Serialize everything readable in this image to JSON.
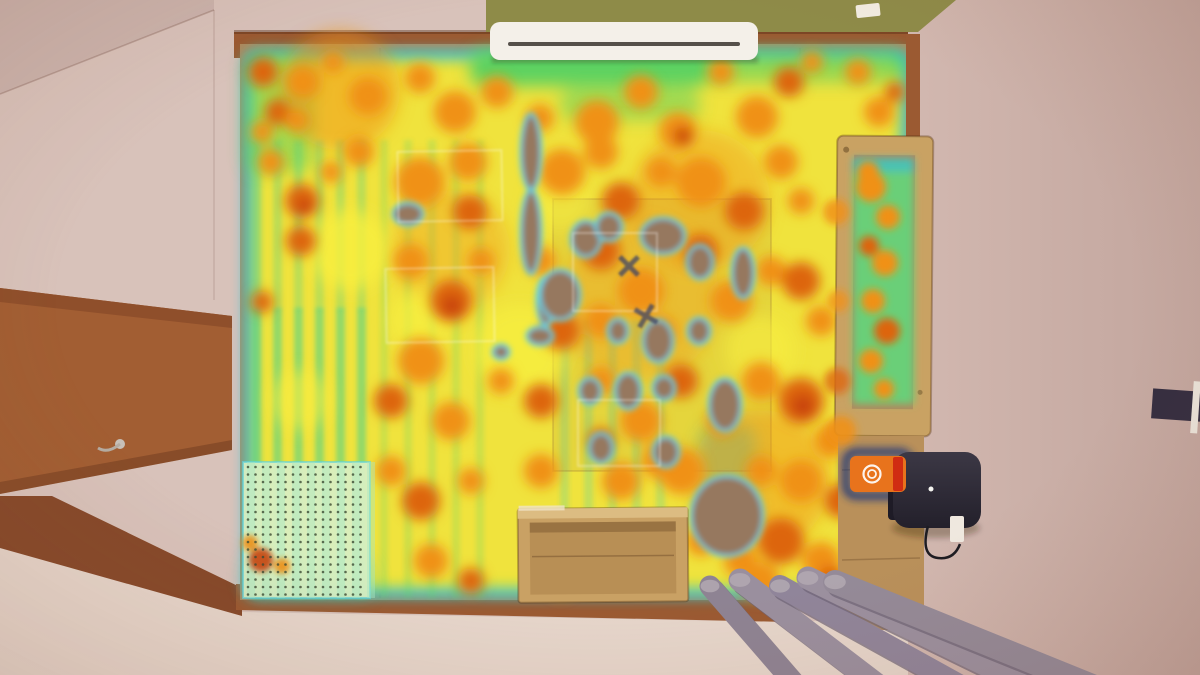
{
  "scene": {
    "description": "Top-down photo of a test room with a robot-vacuum coverage heatmap overlaid on the floor",
    "palette": {
      "wall": "#d8c2ba",
      "ceiling_shade": "#cbb3ac",
      "wall_right": "#d2b8b0",
      "wall_right_edge": "#c2a59d",
      "wall_bottom": "#e6d6cb",
      "green_wall": "#8e8b48",
      "trim": "#9b5a32",
      "trim_dark": "#86492a",
      "door": "#a25e33",
      "door_dark": "#8f4f2b",
      "floor": "#b2885d",
      "bed_wood": "#c9a263",
      "platform_wood": "#b9905a",
      "box_wood": "#c9a164",
      "box_rim": "#dcbc82",
      "box_inner": "#b88f55",
      "ac_body": "#f4f0e9",
      "ac_vent": "#55504a",
      "dock_top": "#3c3845",
      "dock_bottom": "#23202b",
      "dock_side": "#1e1b26",
      "dock_led": "#f5f5f0",
      "marker_orange": "#e8731c",
      "marker_red": "#d02c12",
      "marker_glow": "#16327c",
      "outlet": "#efe8df",
      "cable": "#1d1c22",
      "switch": "#f2ece2",
      "device": "#352e40",
      "device_clip": "#e9e2d8"
    },
    "heat": {
      "colors": {
        "y": "#f7ef3f",
        "c": "#f09119",
        "d": "#dd650e",
        "r": "#c8430d",
        "g": "#55d162",
        "t": "#3fd0b4",
        "b": "#35b9dc"
      },
      "edge": {
        "cyan": "#2fc4de",
        "green": "#52d44e",
        "yellow": "#f0e33c"
      },
      "hole_fill": "#96785f",
      "hole_rim": "#5bd0e8",
      "cold_rects": [
        [
          470,
          50,
          240,
          36,
          "g",
          0.95
        ],
        [
          700,
          50,
          206,
          32,
          "g",
          0.6
        ],
        [
          244,
          52,
          70,
          120,
          "g",
          0.5
        ],
        [
          700,
          425,
          56,
          110,
          "t",
          0.5
        ],
        [
          244,
          558,
          130,
          40,
          "t",
          0.4
        ],
        [
          560,
          88,
          140,
          32,
          "g",
          0.5
        ]
      ],
      "washes": [
        [
          340,
          90,
          60,
          "c",
          0.5
        ],
        [
          700,
          200,
          70,
          "c",
          0.4
        ],
        [
          640,
          300,
          80,
          "c",
          0.35
        ],
        [
          760,
          480,
          70,
          "c",
          0.45
        ],
        [
          450,
          250,
          60,
          "c",
          0.35
        ],
        [
          350,
          250,
          40,
          "y",
          0.8
        ],
        [
          520,
          350,
          45,
          "y",
          0.7
        ],
        [
          420,
          320,
          30,
          "y",
          0.7
        ],
        [
          760,
          350,
          35,
          "y",
          0.6
        ],
        [
          300,
          400,
          30,
          "y",
          0.6
        ],
        [
          560,
          200,
          30,
          "y",
          0.5
        ]
      ],
      "blobs": [
        [
          263,
          72,
          15,
          "d"
        ],
        [
          278,
          112,
          13,
          "d"
        ],
        [
          262,
          132,
          11,
          "c"
        ],
        [
          303,
          82,
          17,
          "c"
        ],
        [
          297,
          120,
          12,
          "c"
        ],
        [
          333,
          62,
          11,
          "c"
        ],
        [
          368,
          96,
          19,
          "c"
        ],
        [
          420,
          78,
          15,
          "c"
        ],
        [
          455,
          112,
          21,
          "c"
        ],
        [
          497,
          92,
          16,
          "c"
        ],
        [
          540,
          118,
          14,
          "c"
        ],
        [
          597,
          122,
          22,
          "c"
        ],
        [
          641,
          92,
          17,
          "c"
        ],
        [
          678,
          131,
          19,
          "c"
        ],
        [
          683,
          136,
          9,
          "r"
        ],
        [
          721,
          72,
          13,
          "c"
        ],
        [
          757,
          117,
          21,
          "c"
        ],
        [
          789,
          82,
          15,
          "d"
        ],
        [
          812,
          62,
          11,
          "c"
        ],
        [
          858,
          72,
          13,
          "c"
        ],
        [
          879,
          112,
          15,
          "c"
        ],
        [
          895,
          92,
          10,
          "d"
        ],
        [
          271,
          162,
          13,
          "c"
        ],
        [
          302,
          201,
          17,
          "d"
        ],
        [
          305,
          207,
          8,
          "r"
        ],
        [
          331,
          172,
          11,
          "c"
        ],
        [
          359,
          152,
          15,
          "c"
        ],
        [
          301,
          241,
          15,
          "d"
        ],
        [
          420,
          182,
          25,
          "c"
        ],
        [
          468,
          162,
          19,
          "c"
        ],
        [
          470,
          212,
          17,
          "d"
        ],
        [
          562,
          172,
          23,
          "c"
        ],
        [
          601,
          152,
          17,
          "c"
        ],
        [
          621,
          201,
          19,
          "d"
        ],
        [
          661,
          172,
          15,
          "c"
        ],
        [
          701,
          182,
          25,
          "c"
        ],
        [
          744,
          211,
          19,
          "d"
        ],
        [
          781,
          162,
          17,
          "c"
        ],
        [
          801,
          201,
          13,
          "c"
        ],
        [
          262,
          302,
          11,
          "d"
        ],
        [
          411,
          261,
          17,
          "c"
        ],
        [
          451,
          301,
          21,
          "d"
        ],
        [
          452,
          306,
          10,
          "r"
        ],
        [
          481,
          261,
          13,
          "c"
        ],
        [
          541,
          261,
          15,
          "c"
        ],
        [
          601,
          251,
          19,
          "d"
        ],
        [
          641,
          291,
          23,
          "c"
        ],
        [
          701,
          251,
          17,
          "d"
        ],
        [
          731,
          301,
          21,
          "c"
        ],
        [
          771,
          271,
          15,
          "c"
        ],
        [
          801,
          281,
          19,
          "d"
        ],
        [
          821,
          321,
          15,
          "c"
        ],
        [
          601,
          321,
          17,
          "c"
        ],
        [
          561,
          331,
          19,
          "d"
        ],
        [
          661,
          331,
          15,
          "c"
        ],
        [
          421,
          361,
          23,
          "c"
        ],
        [
          391,
          401,
          17,
          "d"
        ],
        [
          451,
          421,
          19,
          "c"
        ],
        [
          501,
          381,
          13,
          "c"
        ],
        [
          541,
          401,
          17,
          "d"
        ],
        [
          601,
          381,
          15,
          "c"
        ],
        [
          641,
          421,
          21,
          "c"
        ],
        [
          681,
          381,
          17,
          "d"
        ],
        [
          721,
          421,
          15,
          "c"
        ],
        [
          761,
          381,
          19,
          "c"
        ],
        [
          801,
          401,
          23,
          "d"
        ],
        [
          803,
          406,
          11,
          "r"
        ],
        [
          831,
          441,
          17,
          "c"
        ],
        [
          601,
          441,
          13,
          "d"
        ],
        [
          661,
          461,
          19,
          "c"
        ],
        [
          391,
          471,
          15,
          "c"
        ],
        [
          421,
          501,
          19,
          "d"
        ],
        [
          471,
          481,
          13,
          "c"
        ],
        [
          541,
          471,
          17,
          "c"
        ],
        [
          621,
          481,
          19,
          "c"
        ],
        [
          681,
          471,
          23,
          "c"
        ],
        [
          721,
          501,
          17,
          "d"
        ],
        [
          761,
          471,
          15,
          "c"
        ],
        [
          801,
          481,
          21,
          "c"
        ],
        [
          841,
          501,
          17,
          "d"
        ],
        [
          861,
          541,
          15,
          "c"
        ],
        [
          821,
          561,
          19,
          "c"
        ],
        [
          781,
          541,
          23,
          "d"
        ],
        [
          741,
          561,
          17,
          "c"
        ],
        [
          701,
          541,
          15,
          "c"
        ],
        [
          601,
          541,
          11,
          "c"
        ],
        [
          431,
          561,
          17,
          "c"
        ],
        [
          471,
          581,
          13,
          "d"
        ],
        [
          561,
          581,
          15,
          "c"
        ],
        [
          761,
          581,
          19,
          "c"
        ],
        [
          831,
          581,
          15,
          "d"
        ],
        [
          861,
          571,
          13,
          "c"
        ],
        [
          641,
          581,
          11,
          "c"
        ]
      ],
      "holes": [
        [
          531,
          152,
          10,
          38,
          0
        ],
        [
          531,
          232,
          10,
          42,
          0
        ],
        [
          546,
          301,
          9,
          24,
          0
        ],
        [
          408,
          214,
          15,
          11,
          0
        ],
        [
          586,
          239,
          15,
          18,
          0
        ],
        [
          609,
          227,
          13,
          14,
          0
        ],
        [
          663,
          236,
          22,
          18,
          0
        ],
        [
          700,
          262,
          13,
          17,
          0
        ],
        [
          743,
          273,
          11,
          25,
          0
        ],
        [
          560,
          295,
          20,
          25,
          0
        ],
        [
          618,
          331,
          10,
          12,
          0
        ],
        [
          658,
          341,
          15,
          21,
          0
        ],
        [
          699,
          331,
          11,
          13,
          0
        ],
        [
          628,
          391,
          13,
          18,
          0
        ],
        [
          590,
          391,
          11,
          13,
          0
        ],
        [
          601,
          448,
          12,
          15,
          0
        ],
        [
          666,
          452,
          13,
          15,
          0
        ],
        [
          664,
          388,
          11,
          12,
          0
        ],
        [
          727,
          516,
          36,
          40,
          0
        ],
        [
          853,
          272,
          6,
          105,
          0
        ],
        [
          540,
          336,
          13,
          9,
          0
        ],
        [
          501,
          352,
          8,
          7,
          0
        ],
        [
          725,
          405,
          16,
          26,
          0
        ]
      ],
      "stripe_regions": [
        {
          "x": 252,
          "y": 308,
          "w": 116,
          "h": 290,
          "sw": 9,
          "pitch": 21,
          "color": "#49d08a",
          "op": 0.55
        },
        {
          "x": 252,
          "y": 140,
          "w": 116,
          "h": 170,
          "sw": 9,
          "pitch": 21,
          "color": "#49d08a",
          "op": 0.3
        },
        {
          "x": 380,
          "y": 140,
          "w": 120,
          "h": 458,
          "sw": 8,
          "pitch": 24,
          "color": "#54d06e",
          "op": 0.22
        },
        {
          "x": 560,
          "y": 320,
          "w": 120,
          "h": 240,
          "sw": 9,
          "pitch": 24,
          "color": "#3fd0b4",
          "op": 0.25
        }
      ],
      "rug_rect": [
        553,
        199,
        218,
        272
      ],
      "tape_rects": [
        [
          398,
          151,
          104,
          70,
          -1
        ],
        [
          386,
          268,
          108,
          74,
          -1
        ],
        [
          573,
          233,
          84,
          78,
          0
        ],
        [
          578,
          400,
          82,
          66,
          0
        ]
      ],
      "x_markers": [
        [
          629,
          266,
          13,
          45
        ],
        [
          646,
          316,
          13,
          30
        ]
      ],
      "x_marker_color": "#3f4566",
      "bed_blobs": [
        [
          868,
          172,
          11,
          "c"
        ],
        [
          871,
          187,
          15,
          "c"
        ],
        [
          888,
          217,
          12,
          "c"
        ],
        [
          869,
          246,
          10,
          "d"
        ],
        [
          885,
          263,
          13,
          "c"
        ],
        [
          873,
          301,
          12,
          "c"
        ],
        [
          887,
          331,
          13,
          "d"
        ],
        [
          871,
          361,
          12,
          "c"
        ],
        [
          884,
          389,
          10,
          "c"
        ]
      ],
      "rail_blobs": [
        [
          836,
          212,
          13,
          "c",
          0.85
        ],
        [
          838,
          301,
          11,
          "c",
          0.8
        ],
        [
          837,
          381,
          13,
          "d",
          0.8
        ],
        [
          841,
          431,
          15,
          "c",
          0.9
        ]
      ],
      "dot_zone": {
        "x": 243,
        "y": 462,
        "w": 127,
        "h": 136,
        "pitch": 7.5,
        "dot_r": 1.3,
        "bg": "#d9efc4",
        "dot": "#3c4a33",
        "stripe": "#a8e6c2",
        "rim": "#5fd4de",
        "spots": [
          [
            261,
            560,
            12,
            "r"
          ],
          [
            282,
            566,
            8,
            "c"
          ],
          [
            250,
            543,
            8,
            "c"
          ]
        ]
      }
    },
    "objects": {
      "pipes": {
        "items": [
          [
            710,
            586,
            800,
            690,
            21
          ],
          [
            740,
            580,
            884,
            690,
            23
          ],
          [
            780,
            586,
            968,
            690,
            22
          ],
          [
            808,
            578,
            1038,
            690,
            23
          ],
          [
            835,
            582,
            1102,
            690,
            24
          ]
        ],
        "colors": [
          "#8e8393",
          "#9a8f9e",
          "#90859a",
          "#9b909f",
          "#948a98"
        ],
        "shadow": "#6e6477",
        "cap": "#b3a9b2"
      },
      "grain_lines": [
        380,
        520,
        660,
        800
      ]
    }
  }
}
